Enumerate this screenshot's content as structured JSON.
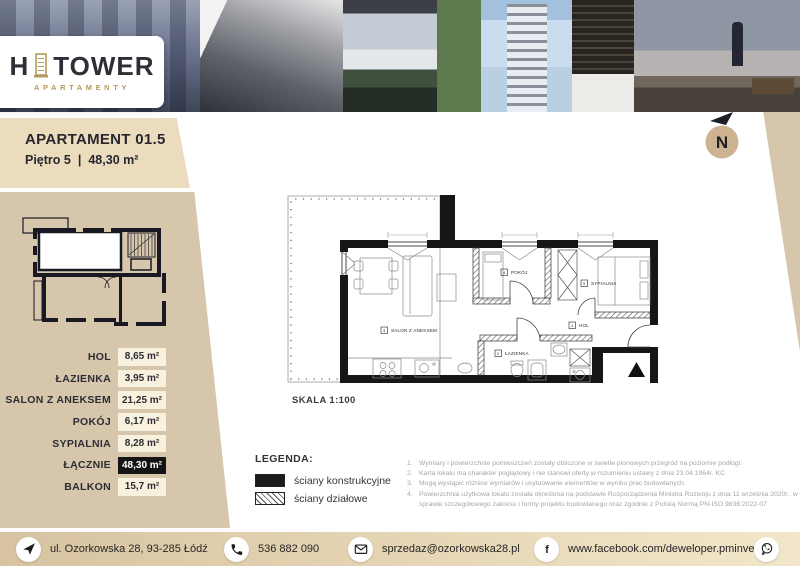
{
  "logo": {
    "h": "H",
    "tower": "TOWER",
    "subtitle": "APARTAMENTY"
  },
  "header": {
    "title": "APARTAMENT 01.5",
    "floor": "Piętro 5",
    "divider": "|",
    "area": "48,30 m²"
  },
  "compass_letter": "N",
  "sidebar": {
    "rows": [
      {
        "label": "HOL",
        "value": "8,65 m²"
      },
      {
        "label": "ŁAZIENKA",
        "value": "3,95 m²"
      },
      {
        "label": "SALON Z ANEKSEM",
        "value": "21,25 m²"
      },
      {
        "label": "POKÓJ",
        "value": "6,17 m²"
      },
      {
        "label": "SYPIALNIA",
        "value": "8,28 m²"
      },
      {
        "label": "ŁĄCZNIE",
        "value": "48,30 m²"
      },
      {
        "label": "BALKON",
        "value": "15,7 m²"
      }
    ]
  },
  "plan": {
    "scale": "SKALA 1:100",
    "room_labels": [
      {
        "num": "1",
        "name": "HOL"
      },
      {
        "num": "2",
        "name": "ŁAZIENKA"
      },
      {
        "num": "3",
        "name": "SALON Z ANEKSEM"
      },
      {
        "num": "4",
        "name": "POKÓJ"
      },
      {
        "num": "5",
        "name": "SYPIALNIA"
      }
    ]
  },
  "legend": {
    "title": "LEGENDA:",
    "wall_structural": "ściany konstrukcyjne",
    "wall_partition": "ściany działowe"
  },
  "notes": [
    {
      "num": "1.",
      "text": "Wymiary i powierzchnie pomieszczeń zostały obliczone w świetle pionowych przegród na poziomie podłogi."
    },
    {
      "num": "2.",
      "text": "Karta lokalu ma charakter poglądowy i nie stanowi oferty w rozumieniu ustawy z dnia 23.04.1964r. KC"
    },
    {
      "num": "3.",
      "text": "Mogą wystąpić różnice wymiarów i usytuowanie elementów w wyniku prac budowlanych."
    },
    {
      "num": "4.",
      "text": "Powierzchnia użytkowa lokalu została określona na podstawie Rozporządzenia Ministra Rozwoju z dnia 11 września 2020r., w sprawie szczegółowego zakresu i formy projektu budowlanego oraz zgodnie z Polską Normą PN-ISO 9836:2022-07"
    }
  ],
  "footer": {
    "address": "ul. Ozorkowska 28, 93-285 Łódź",
    "phone": "536 882 090",
    "email": "sprzedaz@ozorkowska28.pl",
    "facebook": "www.facebook.com/deweloper.pminvest",
    "facebook_glyph": "f"
  },
  "colors": {
    "beige": "#d5c6ac",
    "beige_light": "#ecdcbe",
    "cream": "#f8f1de",
    "gold": "#b6995e",
    "dark_text": "#2b2b33",
    "total_badge": "#141414"
  }
}
